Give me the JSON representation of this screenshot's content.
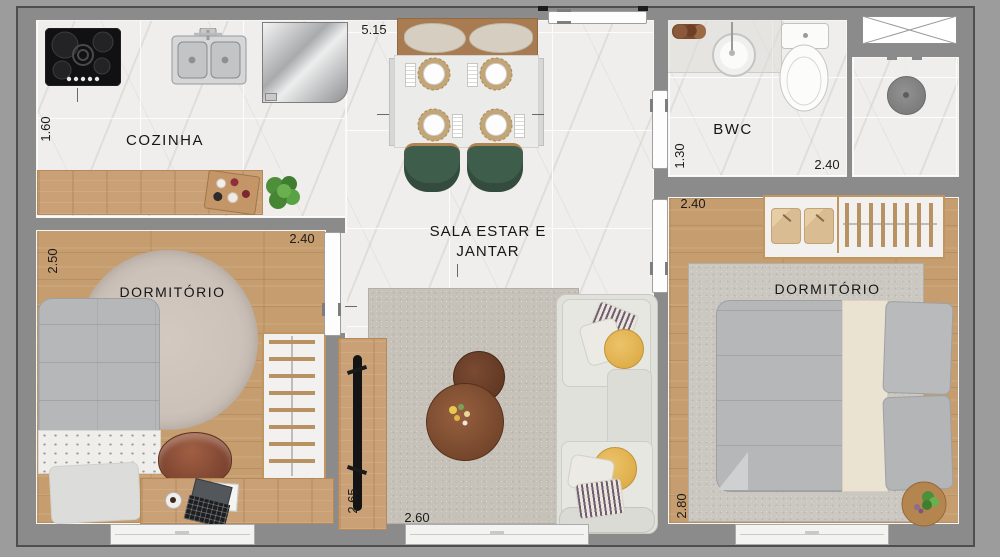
{
  "plan": {
    "rooms": {
      "kitchen": {
        "label": "COZINHA",
        "dim_depth": "1.60"
      },
      "living": {
        "label_line1": "SALA ESTAR E",
        "label_line2": "JANTAR",
        "dim_width_top": "5.15",
        "dim_tv_wall": "2.65",
        "dim_window": "2.60"
      },
      "bwc": {
        "label": "BWC",
        "dim_depth": "1.30",
        "dim_width": "2.40"
      },
      "bedroom_left": {
        "label": "DORMITÓRIO",
        "dim_depth": "2.50",
        "dim_width": "2.40"
      },
      "bedroom_right": {
        "label": "DORMITÓRIO",
        "dim_width": "2.40",
        "dim_depth": "2.80"
      }
    },
    "colors": {
      "background": "#9c9c9c",
      "wall": "#8b8b8b",
      "marble_floor": "#efeeec",
      "wood_floor": "#c69d6f",
      "wood_counter": "#caa176",
      "chair_green": "#3f5d4b",
      "sofa": "#e2e3dd",
      "pillow_yellow": "#dfae48",
      "rug": "#c7c2b9",
      "coffee_table": "#7c4c33",
      "leather_chair": "#8a4f3b",
      "plant": "#4e8f3a"
    }
  }
}
